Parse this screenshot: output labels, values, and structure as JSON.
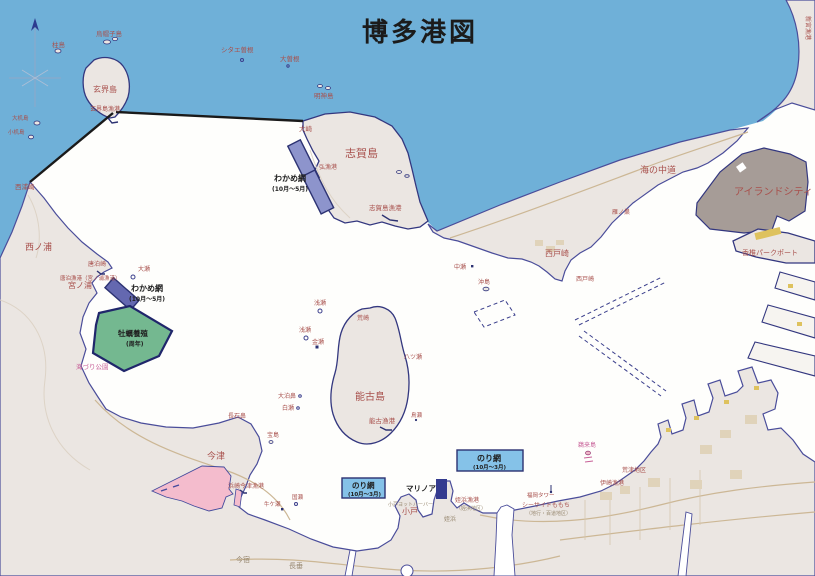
{
  "title": "博多港図",
  "colors": {
    "sea": "#6fb0d8",
    "bay": "#fefefc",
    "land": "#ebe6e2",
    "coastline": "#4a4d9a",
    "island_city_fill": "#a69c97",
    "oyster_zone": "#74b890",
    "wakame_zone_dark": "#6468b0",
    "wakame_zone_light": "#8d94cc",
    "nori_zone": "#85c2e8",
    "tidal_flat_pink": "#f4bccd",
    "warehouse_yellow": "#dec25e",
    "port_boundary": "#1a1a1a",
    "place_label": "#a8504c"
  },
  "zones": [
    {
      "name": "wakame-net-shikanoshima",
      "label": "わかめ網",
      "period": "(10月〜5月)"
    },
    {
      "name": "wakame-net-miyanoura",
      "label": "わかめ網",
      "period": "(10月〜5月)"
    },
    {
      "name": "oyster-farm",
      "label": "牡蠣養殖",
      "period": "(周年)"
    },
    {
      "name": "nori-net-center",
      "label": "のり網",
      "period": "(10月〜3月)"
    },
    {
      "name": "nori-net-odo",
      "label": "のり網",
      "period": "(10月〜3月)"
    }
  ],
  "places": [
    {
      "name": "hashirajima-label",
      "text": "柱島",
      "x": 52,
      "y": 47,
      "s": 6.5
    },
    {
      "name": "eboshijima-label",
      "text": "烏帽子島",
      "x": 96,
      "y": 36,
      "s": 6.5
    },
    {
      "name": "shitaesone-label",
      "text": "シタエ曽根",
      "x": 221,
      "y": 52,
      "s": 6.5
    },
    {
      "name": "osone-label",
      "text": "大曽根",
      "x": 280,
      "y": 61,
      "s": 6.5
    },
    {
      "name": "myojinjima-label",
      "text": "明神島",
      "x": 314,
      "y": 98,
      "s": 6.5
    },
    {
      "name": "genkaijima-label",
      "text": "玄界島",
      "x": 93,
      "y": 92,
      "s": 8
    },
    {
      "name": "genkaijima-port-label",
      "text": "玄界島漁港",
      "x": 90,
      "y": 111,
      "s": 6
    },
    {
      "name": "osaki-label",
      "text": "大崎",
      "x": 299,
      "y": 131,
      "s": 6.5
    },
    {
      "name": "shikanoshima-label",
      "text": "志賀島",
      "x": 345,
      "y": 157,
      "s": 11
    },
    {
      "name": "hiro-port-label",
      "text": "弘漁港",
      "x": 319,
      "y": 169,
      "s": 6
    },
    {
      "name": "shikanoshima-port-label",
      "text": "志賀島漁港",
      "x": 369,
      "y": 210,
      "s": 6.5
    },
    {
      "name": "wakame-shika-label",
      "text": "わかめ網",
      "x": 274,
      "y": 181,
      "s": 8,
      "cls": "black"
    },
    {
      "name": "wakame-shika-period",
      "text": "(10月〜5月)",
      "x": 272,
      "y": 191,
      "s": 6,
      "cls": "black"
    },
    {
      "name": "uminonakamichi-label",
      "text": "海の中道",
      "x": 640,
      "y": 173,
      "s": 9
    },
    {
      "name": "saitozaki-label",
      "text": "西戸崎",
      "x": 545,
      "y": 256,
      "s": 8
    },
    {
      "name": "saitozaki-cape-label",
      "text": "西戸崎",
      "x": 576,
      "y": 281,
      "s": 6
    },
    {
      "name": "gannosu-label",
      "text": "雁ノ巣",
      "x": 612,
      "y": 214,
      "s": 6
    },
    {
      "name": "island-city-label",
      "text": "アイランドシティ",
      "x": 734,
      "y": 195,
      "s": 10
    },
    {
      "name": "kashii-parkport-label",
      "text": "香椎パークポート",
      "x": 742,
      "y": 255,
      "s": 7
    },
    {
      "name": "nakase-label",
      "text": "中瀬",
      "x": 454,
      "y": 269,
      "s": 6
    },
    {
      "name": "okishima-label",
      "text": "沖島",
      "x": 478,
      "y": 284,
      "s": 6
    },
    {
      "name": "nishiurazaki-label",
      "text": "西浦崎",
      "x": 15,
      "y": 189,
      "s": 6.5
    },
    {
      "name": "nishinoura-label",
      "text": "西ノ浦",
      "x": 25,
      "y": 250,
      "s": 9
    },
    {
      "name": "karadomarizaki-label",
      "text": "唐泊崎",
      "x": 88,
      "y": 266,
      "s": 6
    },
    {
      "name": "karadomari-port-label",
      "text": "唐泊漁港（宮ノ浦漁港）",
      "x": 60,
      "y": 280,
      "s": 5.5
    },
    {
      "name": "miyanoura-label",
      "text": "宮ノ浦",
      "x": 68,
      "y": 288,
      "s": 8
    },
    {
      "name": "ose-label",
      "text": "大瀬",
      "x": 138,
      "y": 271,
      "s": 6
    },
    {
      "name": "wakame-miya-label",
      "text": "わかめ網",
      "x": 131,
      "y": 291,
      "s": 8,
      "cls": "black"
    },
    {
      "name": "wakame-miya-period",
      "text": "(10月〜5月)",
      "x": 129,
      "y": 301,
      "s": 6,
      "cls": "black"
    },
    {
      "name": "oyster-label",
      "text": "牡蠣養殖",
      "x": 118,
      "y": 336,
      "s": 7.5,
      "cls": "black"
    },
    {
      "name": "oyster-period",
      "text": "(周年)",
      "x": 126,
      "y": 346,
      "s": 6,
      "cls": "black"
    },
    {
      "name": "umizuri-park-label",
      "text": "海づり公園",
      "x": 76,
      "y": 369,
      "s": 6.5,
      "cls": "pink"
    },
    {
      "name": "asase1-label",
      "text": "浅瀬",
      "x": 314,
      "y": 305,
      "s": 6
    },
    {
      "name": "asase2-label",
      "text": "浅瀬",
      "x": 299,
      "y": 332,
      "s": 6
    },
    {
      "name": "kanase-label",
      "text": "金瀬",
      "x": 312,
      "y": 344,
      "s": 6
    },
    {
      "name": "arasaki-label",
      "text": "荒崎",
      "x": 357,
      "y": 320,
      "s": 6
    },
    {
      "name": "nokonoshima-label",
      "text": "能古島",
      "x": 355,
      "y": 400,
      "s": 10
    },
    {
      "name": "hatsuse-label",
      "text": "八ツ瀬",
      "x": 404,
      "y": 359,
      "s": 6
    },
    {
      "name": "noko-port-label",
      "text": "能古漁港",
      "x": 369,
      "y": 423,
      "s": 6.5
    },
    {
      "name": "torise-label",
      "text": "鳥瀬",
      "x": 411,
      "y": 417,
      "s": 5.5
    },
    {
      "name": "odomaribana-label",
      "text": "大泊鼻",
      "x": 278,
      "y": 398,
      "s": 6
    },
    {
      "name": "shirase-label",
      "text": "白瀬",
      "x": 282,
      "y": 410,
      "s": 6
    },
    {
      "name": "nagaishibana-label",
      "text": "長石鼻",
      "x": 228,
      "y": 418,
      "s": 6
    },
    {
      "name": "takarajima-label",
      "text": "宝島",
      "x": 267,
      "y": 437,
      "s": 6
    },
    {
      "name": "imazu-label",
      "text": "今津",
      "x": 207,
      "y": 459,
      "s": 9
    },
    {
      "name": "hamasaki-imazu-port-label",
      "text": "浜崎今津漁港",
      "x": 228,
      "y": 488,
      "s": 6
    },
    {
      "name": "kunise-label",
      "text": "国瀬",
      "x": 292,
      "y": 499,
      "s": 5.5
    },
    {
      "name": "ushigase-label",
      "text": "牛ケ瀬",
      "x": 264,
      "y": 506,
      "s": 5.5
    },
    {
      "name": "nagatare-label",
      "text": "長垂",
      "x": 289,
      "y": 568,
      "s": 7,
      "cls": "gray"
    },
    {
      "name": "imajuku-label",
      "text": "今宿",
      "x": 236,
      "y": 562,
      "s": 7,
      "cls": "gray"
    },
    {
      "name": "nori-center-label",
      "text": "のり網",
      "x": 477,
      "y": 461,
      "s": 8,
      "cls": "black"
    },
    {
      "name": "nori-center-period",
      "text": "(10月〜3月)",
      "x": 473,
      "y": 469,
      "s": 5.5,
      "cls": "black"
    },
    {
      "name": "nori-odo-label",
      "text": "のり網",
      "x": 352,
      "y": 488,
      "s": 7.5,
      "cls": "black"
    },
    {
      "name": "nori-odo-period",
      "text": "(10月〜3月)",
      "x": 348,
      "y": 496,
      "s": 5.5,
      "cls": "black"
    },
    {
      "name": "marinoa-label",
      "text": "マリノア",
      "x": 406,
      "y": 491,
      "s": 7.5,
      "cls": "black"
    },
    {
      "name": "odo-label",
      "text": "小戸",
      "x": 402,
      "y": 514,
      "s": 8
    },
    {
      "name": "odo-yacht-harbor-label",
      "text": "小戸ヨットハーバー",
      "x": 388,
      "y": 506,
      "s": 5,
      "cls": "gray"
    },
    {
      "name": "meinohama-port-label",
      "text": "姪浜漁港",
      "x": 455,
      "y": 502,
      "s": 6
    },
    {
      "name": "meinohama-district-label",
      "text": "（姪浜地区）",
      "x": 456,
      "y": 510,
      "s": 5,
      "cls": "gray"
    },
    {
      "name": "meinohama-label",
      "text": "姪浜",
      "x": 444,
      "y": 521,
      "s": 6,
      "cls": "gray"
    },
    {
      "name": "seaside-momochi-label",
      "text": "シーサイドももち",
      "x": 522,
      "y": 507,
      "s": 6
    },
    {
      "name": "jigyo-momochi-district-label",
      "text": "（地行・百道地区）",
      "x": 526,
      "y": 515,
      "s": 5,
      "cls": "gray"
    },
    {
      "name": "fukuoka-tower-label",
      "text": "福岡タワー",
      "x": 527,
      "y": 497,
      "s": 5.5
    },
    {
      "name": "isaki-port-label",
      "text": "伊崎漁港",
      "x": 600,
      "y": 485,
      "s": 6
    },
    {
      "name": "aratsu-district-label",
      "text": "荒津地区",
      "x": 622,
      "y": 472,
      "s": 6
    },
    {
      "name": "ukishima-label",
      "text": "鵜来島",
      "x": 578,
      "y": 447,
      "s": 6,
      "cls": "pink"
    },
    {
      "name": "shingu-port-label",
      "text": "新宮漁港",
      "x": 806,
      "y": 16,
      "s": 6,
      "rot": 90
    },
    {
      "name": "otsukuejima-label",
      "text": "大机島",
      "x": 12,
      "y": 120,
      "s": 5.5
    },
    {
      "name": "kotsukuejima-label",
      "text": "小机島",
      "x": 8,
      "y": 134,
      "s": 5.5
    }
  ]
}
